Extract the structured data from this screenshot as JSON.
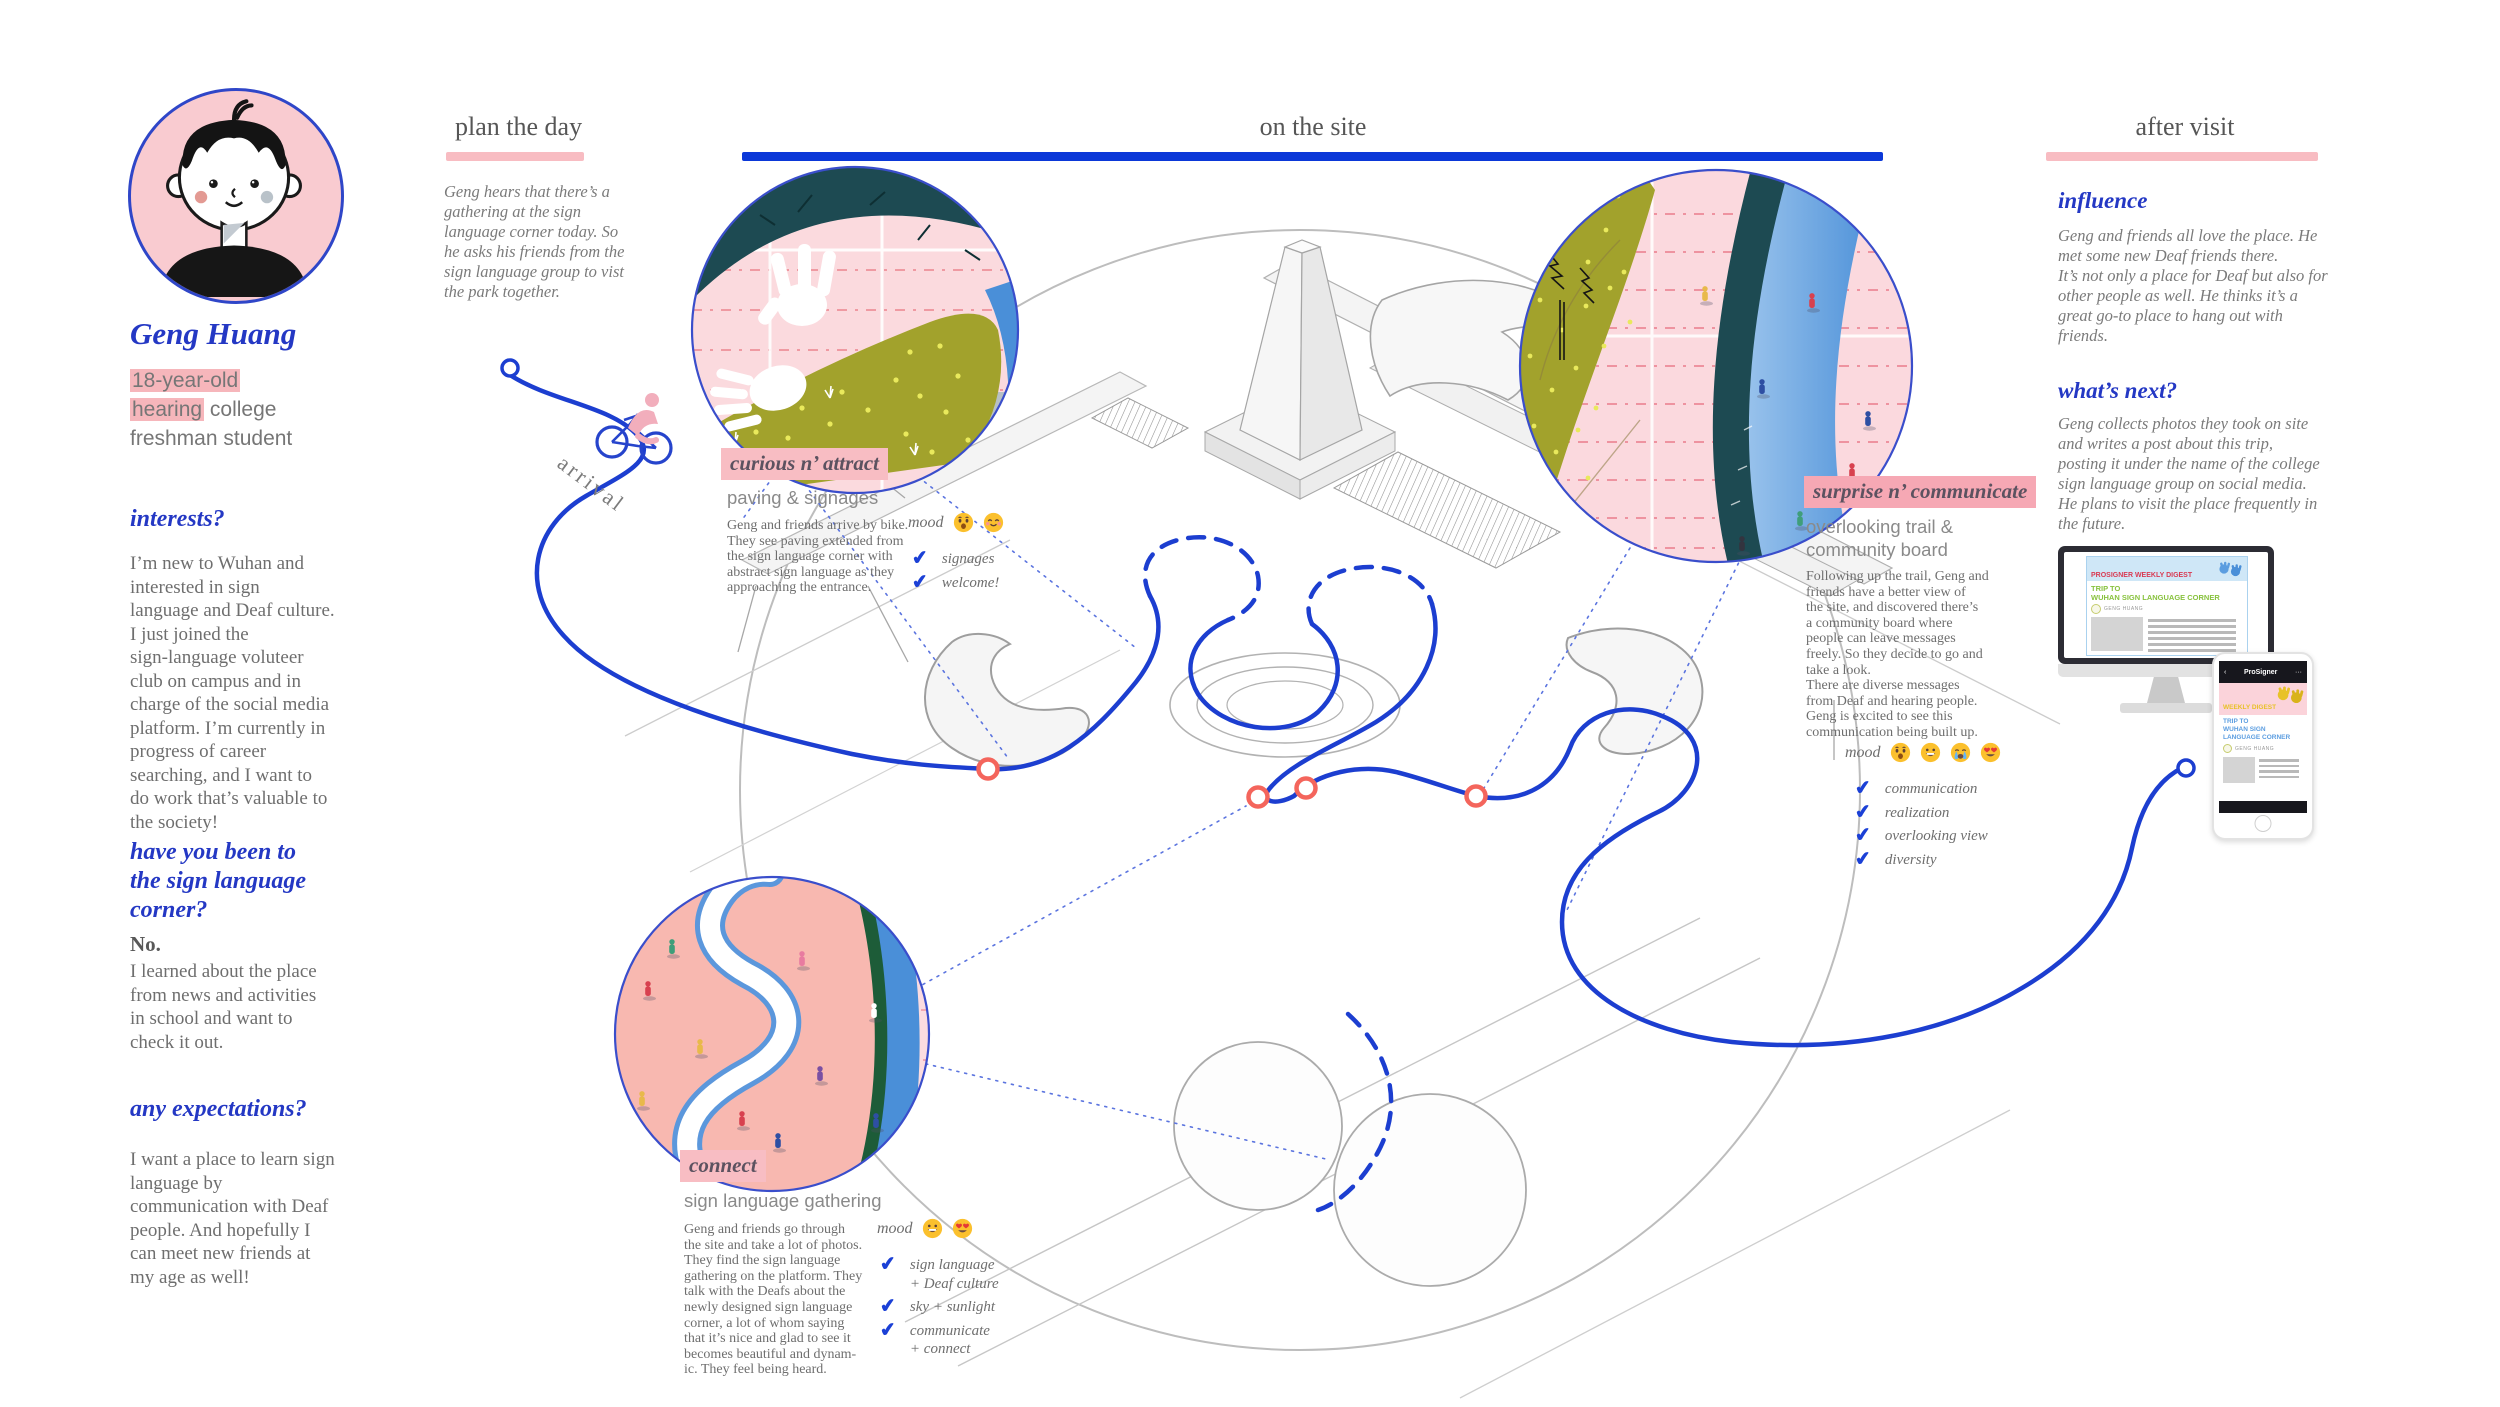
{
  "icons": {
    "check": "✔",
    "back": "‹",
    "more": "···"
  },
  "colors": {
    "accent_blue": "#1c3ed0",
    "highlight_pink": "#f8bcc2",
    "coral_node": "#f4655c",
    "olive": "#a2a22c",
    "teal": "#1d4a52",
    "trail_blue": "#4a8fd8",
    "body_gray": "#6e6e6e"
  },
  "persona": {
    "name": "Geng Huang",
    "descriptor": {
      "line1_highlight": "18-year-old",
      "line2_highlight": "hearing",
      "line2_rest": " college",
      "line3": "freshman student"
    },
    "interests": {
      "heading": "interests?",
      "body": "I’m new to Wuhan and\ninterested in sign\nlanguage and Deaf culture.\nI just joined the\nsign-language voluteer\nclub on campus and in\ncharge of the social media\nplatform. I’m currently in\nprogress of career\nsearching, and I want to\ndo work that’s valuable to\nthe society!"
    },
    "visited": {
      "heading": "have you been to\nthe sign language\ncorner?",
      "answer": "No.",
      "body": "I learned about the place\nfrom news and activities\nin school and want to\ncheck it out."
    },
    "expectations": {
      "heading": "any expectations?",
      "body": "I want a place to learn sign\nlanguage by\ncommunication with Deaf\npeople. And hopefully I\ncan meet new friends at\nmy age as well!"
    }
  },
  "phases": {
    "plan": {
      "title": "plan the day",
      "body": "Geng hears that there’s a\ngathering at the sign\nlanguage corner today. So\nhe asks his friends from the\nsign language group to vist\nthe park together."
    },
    "onsite": {
      "title": "on the site"
    },
    "after": {
      "title": "after visit"
    }
  },
  "journey": {
    "arrival_label": "arrival",
    "stops": [
      {
        "tag": "curious n’ attract",
        "subtitle": "paving & signages",
        "body": "Geng and friends arrive by bike.\nThey see paving extended from\nthe sign language corner with\nabstract sign language as they\napproaching the entrance.",
        "mood_label": "mood",
        "moods": [
          "astonished",
          "smiling-blush"
        ],
        "checks": [
          "signages",
          "welcome!"
        ]
      },
      {
        "tag": "connect",
        "subtitle": "sign language gathering",
        "body": "Geng and friends go through\nthe site and take a lot of photos.\nThey find the sign language\ngathering on the platform. They\ntalk with the Deafs about the\nnewly designed sign language\ncorner, a lot of whom saying\nthat it’s nice and glad to see it\nbecomes beautiful and dynam-\nic. They feel being heard.",
        "mood_label": "mood",
        "moods": [
          "grinning",
          "heart-eyes"
        ],
        "checks": [
          "sign language\n+ Deaf culture",
          "sky + sunlight",
          "communicate\n+ connect"
        ]
      },
      {
        "tag": "surprise n’ communicate",
        "subtitle": "overlooking trail &\ncommunity board",
        "body": "Following up the trail, Geng and\nfriends have a better view of\nthe site, and discovered there’s\na community board where\npeople can leave messages\nfreely. So they decide to go and\ntake a look.\nThere are diverse messages\nfrom Deaf and hearing people.\nGeng is excited to see this\ncommunication being built up.",
        "mood_label": "mood",
        "moods": [
          "astonished",
          "grinning",
          "loudly-crying",
          "heart-eyes"
        ],
        "checks": [
          "communication",
          "realization",
          "overlooking view",
          "diversity"
        ]
      }
    ]
  },
  "after_visit": {
    "influence": {
      "heading": "influence",
      "body": "Geng and friends all love the place. He\nmet some new Deaf friends there.\nIt’s not only a place for Deaf but also for\nother people as well. He thinks it’s a\ngreat go-to place to hang out with\nfriends."
    },
    "whats_next": {
      "heading": "what’s next?",
      "body": "Geng collects photos they took on site\nand writes a post about this trip,\nposting it under the name of the college\nsign language group on social media.\nHe plans to visit the place frequently in\nthe future."
    },
    "monitor": {
      "masthead": "PROSIGNER WEEKLY DIGEST",
      "article_title": "TRIP TO\nWUHAN SIGN LANGUAGE CORNER",
      "byline": "GENG HUANG"
    },
    "phone": {
      "app_name": "ProSigner",
      "banner": "WEEKLY DIGEST",
      "article_title": "TRIP TO\nWUHAN SIGN\nLANGUAGE CORNER",
      "byline": "GENG HUANG"
    }
  }
}
